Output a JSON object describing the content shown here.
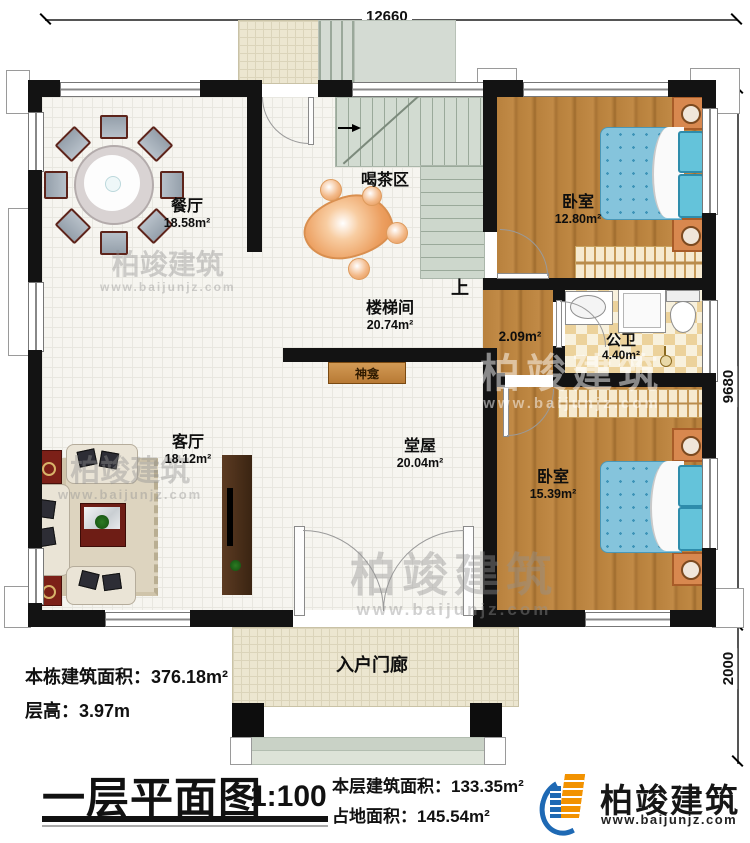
{
  "dimensions": {
    "top_width": "12660",
    "right_height": "9680",
    "porch_depth": "2000"
  },
  "rooms": {
    "dining": {
      "name": "餐厅",
      "area": "18.58m²"
    },
    "tea_area": {
      "name": "喝茶区"
    },
    "stair_hall": {
      "name": "楼梯间",
      "area": "20.74m²"
    },
    "bedroom_top": {
      "name": "卧室",
      "area": "12.80m²"
    },
    "bathroom": {
      "name": "公卫",
      "area": "4.40m²"
    },
    "corridor": {
      "area": "2.09m²"
    },
    "living": {
      "name": "客厅",
      "area": "18.12m²"
    },
    "hall": {
      "name": "堂屋",
      "area": "20.04m²"
    },
    "bedroom_bottom": {
      "name": "卧室",
      "area": "15.39m²"
    },
    "entry_porch": {
      "name": "入户门廊"
    },
    "shrine": {
      "name": "神龛"
    },
    "stairs_direction": "上"
  },
  "notes": {
    "building_total_label": "本栋建筑面积：",
    "building_total_value": "376.18m²",
    "floor_height_label": "层高：",
    "floor_height_value": "3.97m"
  },
  "title_block": {
    "title": "一层平面图",
    "scale": "1:100",
    "floor_area_label": "本层建筑面积：",
    "floor_area_value": "133.35m²",
    "footprint_label": "占地面积：",
    "footprint_value": "145.54m²"
  },
  "brand": {
    "name": "柏竣建筑",
    "url": "www.baijunjz.com"
  },
  "watermark": {
    "brand": "柏竣建筑",
    "url": "www.baijunjz.com"
  }
}
